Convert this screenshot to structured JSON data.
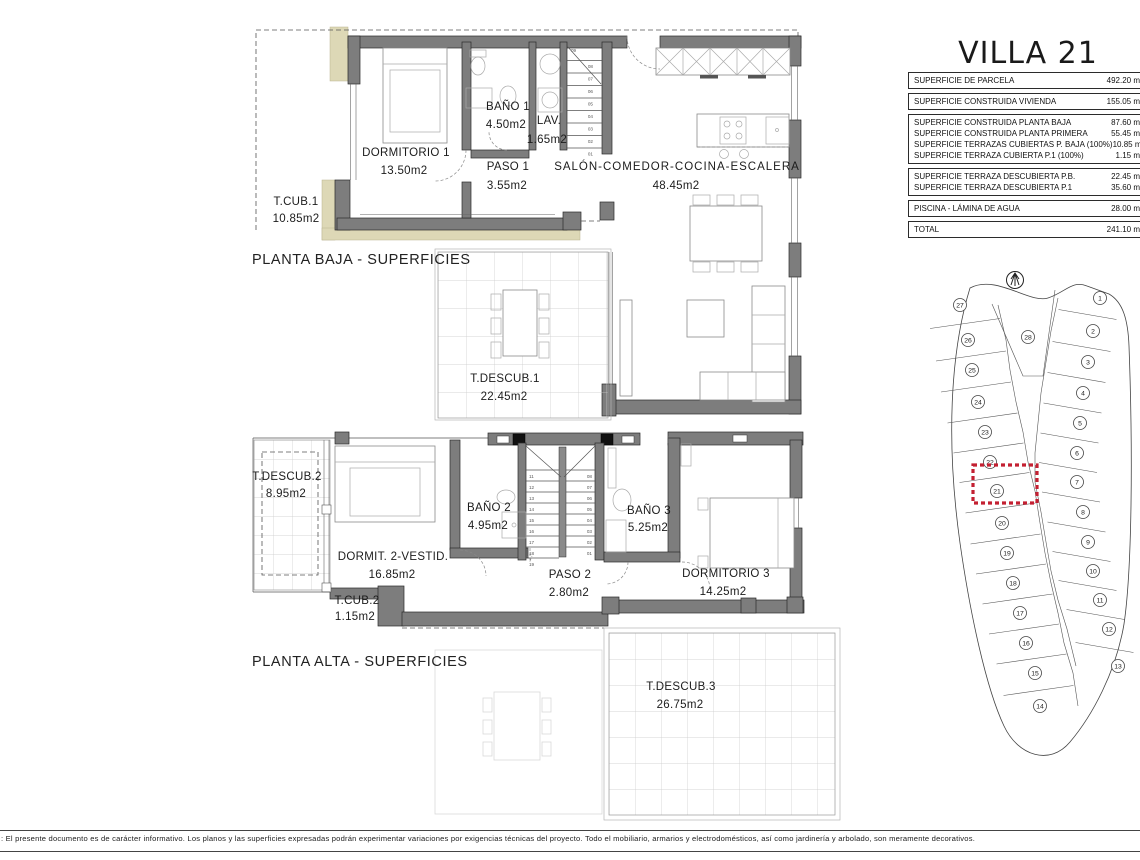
{
  "title": "VILLA 21",
  "summary_table": {
    "sections": [
      {
        "rows": [
          {
            "label": "SUPERFICIE DE PARCELA",
            "value": "492.20 m"
          }
        ]
      },
      {
        "rows": [
          {
            "label": "SUPERFICIE CONSTRUIDA VIVIENDA",
            "value": "155.05 m"
          }
        ]
      },
      {
        "rows": [
          {
            "label": "SUPERFICIE CONSTRUIDA PLANTA BAJA",
            "value": "87.60 m"
          },
          {
            "label": "SUPERFICIE CONSTRUIDA PLANTA PRIMERA",
            "value": "55.45 m"
          },
          {
            "label": "SUPERFICIE TERRAZAS CUBIERTAS P. BAJA (100%)",
            "value": "10.85 m"
          },
          {
            "label": "SUPERFICIE TERRAZA CUBIERTA P.1 (100%)",
            "value": "1.15 m"
          }
        ]
      },
      {
        "rows": [
          {
            "label": "SUPERFICIE TERRAZA DESCUBIERTA P.B.",
            "value": "22.45 m"
          },
          {
            "label": "SUPERFICIE TERRAZA DESCUBIERTA P.1",
            "value": "35.60 m"
          }
        ]
      },
      {
        "rows": [
          {
            "label": "PISCINA - LÁMINA DE AGUA",
            "value": "28.00 m"
          }
        ]
      },
      {
        "rows": [
          {
            "label": "TOTAL",
            "value": "241.10 m"
          }
        ]
      }
    ]
  },
  "planta_baja": {
    "label": "PLANTA BAJA - SUPERFICIES",
    "rooms": [
      {
        "name": "T.CUB.1",
        "area": "10.85m2"
      },
      {
        "name": "DORMITORIO 1",
        "area": "13.50m2"
      },
      {
        "name": "BAÑO 1",
        "area": "4.50m2"
      },
      {
        "name": "LAV.",
        "area": "1.65m2"
      },
      {
        "name": "PASO 1",
        "area": "3.55m2"
      },
      {
        "name": "SALÓN-COMEDOR-COCINA-ESCALERA",
        "area": "48.45m2"
      },
      {
        "name": "T.DESCUB.1",
        "area": "22.45m2"
      }
    ]
  },
  "planta_alta": {
    "label": "PLANTA ALTA - SUPERFICIES",
    "rooms": [
      {
        "name": "T.DESCUB.2",
        "area": "8.95m2"
      },
      {
        "name": "DORMIT. 2-VESTID.",
        "area": "16.85m2"
      },
      {
        "name": "BAÑO 2",
        "area": "4.95m2"
      },
      {
        "name": "BAÑO 3",
        "area": "5.25m2"
      },
      {
        "name": "PASO 2",
        "area": "2.80m2"
      },
      {
        "name": "DORMITORIO 3",
        "area": "14.25m2"
      },
      {
        "name": "T.CUB.2",
        "area": "1.15m2"
      },
      {
        "name": "T.DESCUB.3",
        "area": "26.75m2"
      }
    ]
  },
  "stairs": {
    "baja_top_step": "09",
    "baja_steps": [
      "08",
      "07",
      "06",
      "05",
      "04",
      "03",
      "02",
      "01"
    ],
    "alta_left_steps": [
      "11",
      "12",
      "13",
      "14",
      "15",
      "16",
      "17",
      "18",
      "19"
    ],
    "alta_right_steps": [
      "08",
      "07",
      "06",
      "05",
      "04",
      "03",
      "02",
      "01"
    ]
  },
  "site_plan": {
    "plots": [
      "1",
      "2",
      "3",
      "4",
      "5",
      "6",
      "7",
      "8",
      "9",
      "10",
      "11",
      "12",
      "13",
      "14",
      "15",
      "16",
      "17",
      "18",
      "19",
      "20",
      "21",
      "22",
      "23",
      "24",
      "25",
      "26",
      "27",
      "28"
    ],
    "highlighted_plot": "21"
  },
  "footer": {
    "disclaimer": ": El presente documento es de carácter informativo. Los planos y las superficies expresadas podrán experimentar variaciones por exigencias técnicas del proyecto. Todo el mobiliario, armarios y electrodomésticos, así como jardinería y arbolado, son meramente decorativos."
  },
  "colors": {
    "wall": "#7d7d7d",
    "khaki": "#ddd8b6",
    "highlight_red": "#c32032",
    "paper": "#ffffff"
  }
}
